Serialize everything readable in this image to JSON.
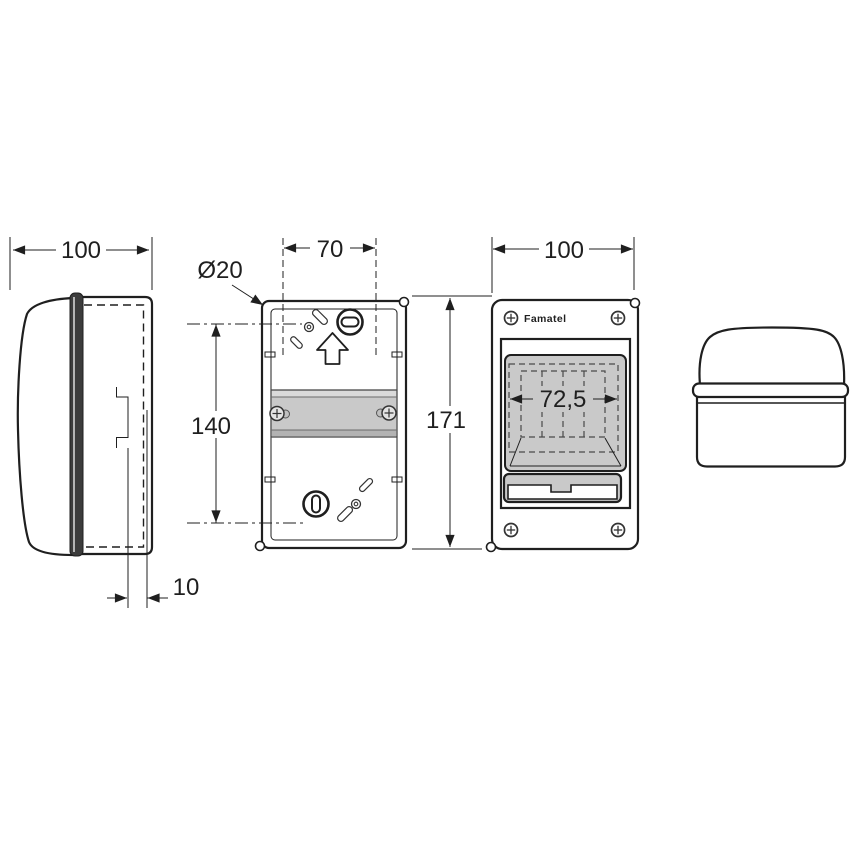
{
  "brand": "Famatel",
  "dimensions": {
    "side_overall_width": "100",
    "side_rail_depth": "10",
    "knockout_diameter": "Ø20",
    "fixing_width": "70",
    "fixing_height": "140",
    "overall_height": "171",
    "front_overall_width": "100",
    "window_cutout_width": "72,5"
  },
  "colors": {
    "line": "#1f1f1f",
    "panel_gray": "#c9c9c9",
    "rail_light": "#dadada",
    "rail_dark": "#b3b3b3",
    "strip_dark": "#3c3c3c"
  }
}
